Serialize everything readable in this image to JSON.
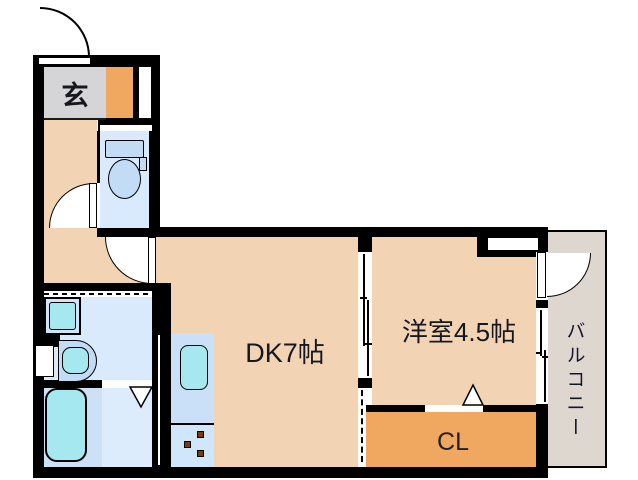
{
  "plan": {
    "type": "apartment-floor-plan",
    "rooms": {
      "genkan": {
        "label": "玄"
      },
      "dk": {
        "label": "DK7帖"
      },
      "western": {
        "label": "洋室4.5帖"
      },
      "closet": {
        "label": "CL"
      },
      "balcony": {
        "label": "バルコニー"
      }
    },
    "colors": {
      "wall": "#000000",
      "room_peach": "#f2d4b5",
      "genkan_gray": "#d5d5d7",
      "cabinet_orange": "#f0a75f",
      "closet_orange": "#f0a75f",
      "balcony_gray": "#ded7d0",
      "wet_room_blue": "#d9eafc",
      "fixture_blue": "#c3dcf5",
      "fixture_teal": "#a5e8ef",
      "burner_brown": "#7a3c0a"
    }
  }
}
